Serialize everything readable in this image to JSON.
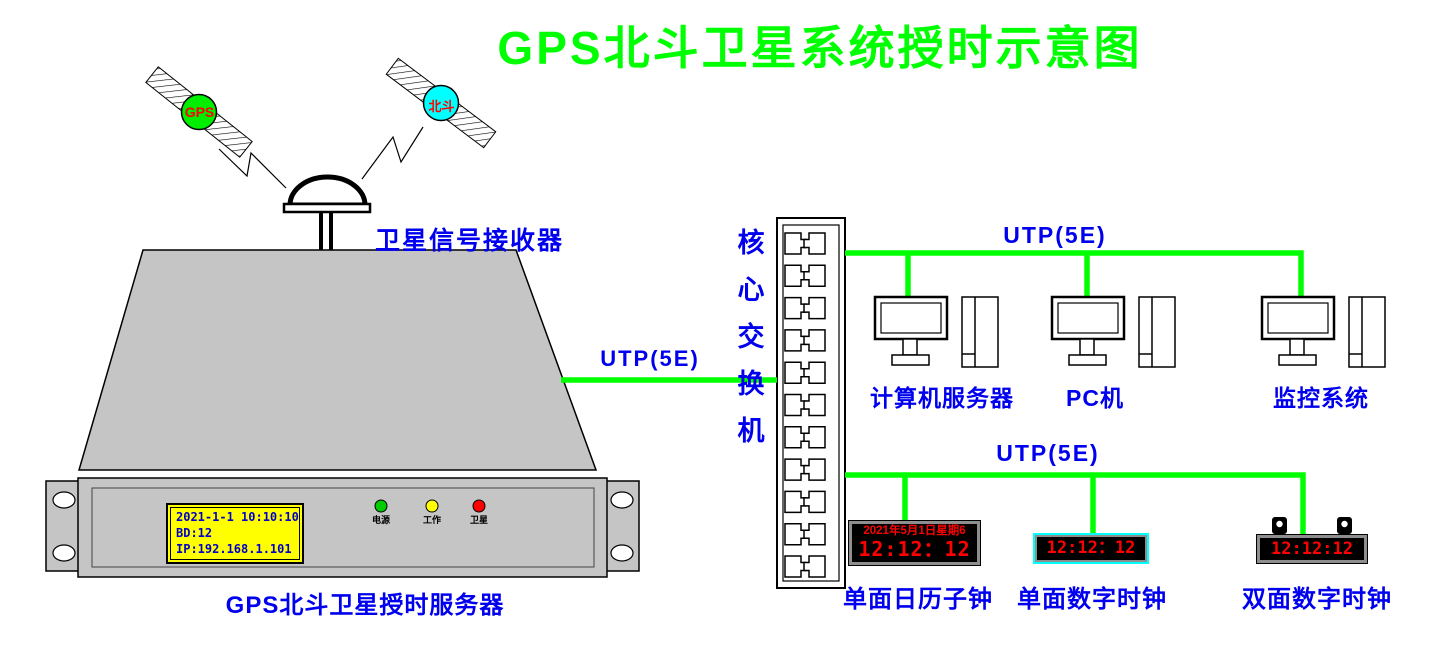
{
  "title": {
    "text": "GPS北斗卫星系统授时示意图",
    "color": "#00FF00"
  },
  "satellites": [
    {
      "name": "GPS",
      "label": "GPS",
      "body_color": "#00EE00",
      "label_color": "#FF0000"
    },
    {
      "name": "BeiDou",
      "label": "北斗",
      "body_color": "#00FFFF",
      "label_color": "#FF0000"
    }
  ],
  "receiver": {
    "label": "卫星信号接收器"
  },
  "server": {
    "label": "GPS北斗卫星授时服务器",
    "lcd": {
      "bg": "#FFFF00",
      "text_color": "#0000CC",
      "lines": [
        "2021-1-1 10:10:10",
        "BD:12",
        "IP:192.168.1.101"
      ]
    },
    "leds": [
      {
        "label": "电源",
        "color": "#00CC00"
      },
      {
        "label": "工作",
        "color": "#FFFF00"
      },
      {
        "label": "卫星",
        "color": "#FF0000"
      }
    ]
  },
  "network": {
    "switch_label": "核心交换机",
    "port_rows": 11,
    "utp_server_link": "UTP(5E)",
    "utp_top_bus": "UTP(5E)",
    "utp_bottom_bus": "UTP(5E)",
    "line_color": "#00FF00"
  },
  "computers": [
    {
      "label": "计算机服务器"
    },
    {
      "label": "PC机"
    },
    {
      "label": "监控系统"
    }
  ],
  "clocks": [
    {
      "label": "单面日历子钟",
      "date": "2021年5月1日星期6",
      "time": "12:12：12",
      "digit_color": "#FF0000"
    },
    {
      "label": "单面数字时钟",
      "time": "12:12：12",
      "border_color": "#00FFFF",
      "digit_color": "#FF0000"
    },
    {
      "label": "双面数字时钟",
      "time": "12:12:12",
      "digit_color": "#FF0000"
    }
  ],
  "colors": {
    "label_blue": "#0000EE",
    "line_green": "#00FF00",
    "chassis_gray": "#C5C5C5"
  }
}
